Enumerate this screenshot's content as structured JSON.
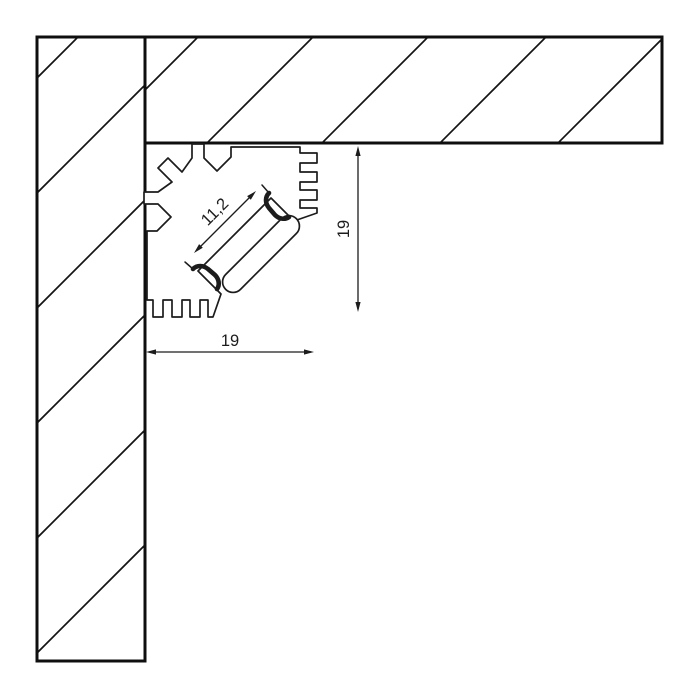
{
  "drawing": {
    "type": "technical-cross-section",
    "subject": "corner-led-profile-in-wall-ceiling-corner",
    "dimensions": {
      "channel": {
        "label": "11,2",
        "orientation": "diagonal-45deg"
      },
      "height": {
        "label": "19",
        "orientation": "vertical"
      },
      "width": {
        "label": "19",
        "orientation": "horizontal"
      }
    },
    "colors": {
      "background": "#ffffff",
      "wall_line": "#0f0f0f",
      "profile_line": "#1c1c1c",
      "dimension_line": "#1c1c1c"
    }
  }
}
